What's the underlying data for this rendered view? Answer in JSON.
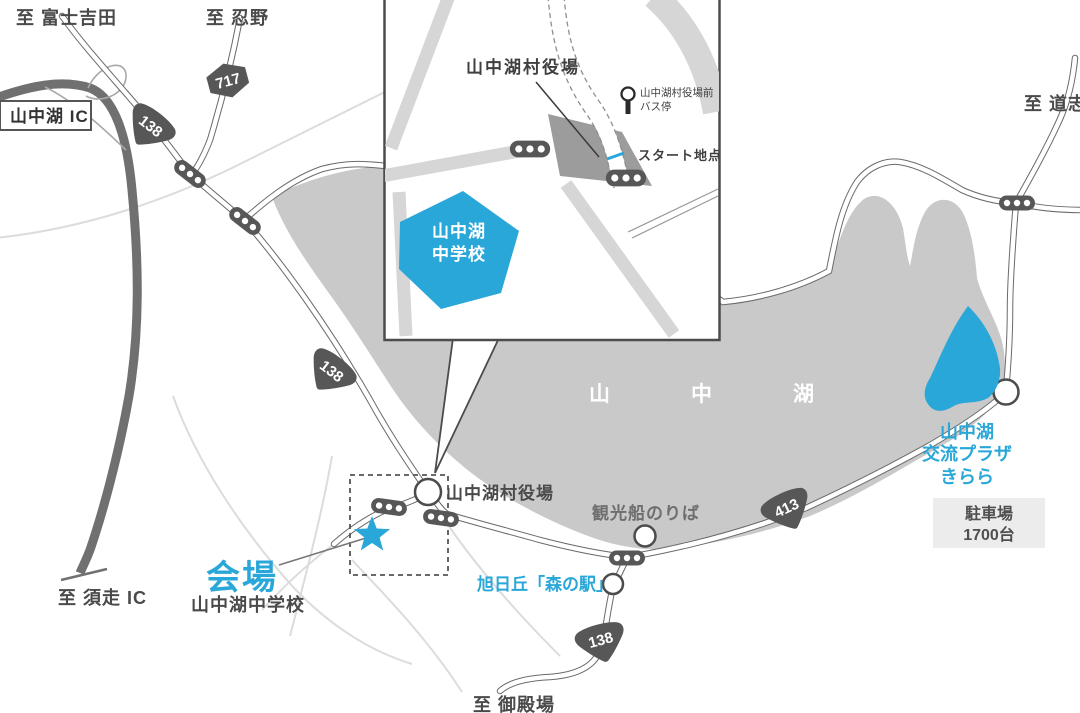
{
  "colors": {
    "accent_blue": "#29a7d8",
    "lake_gray": "#c9c9c9",
    "road_casing_gray": "#6a6a6a",
    "badge_gray": "#575757",
    "building_gray": "#9c9c9c",
    "inset_band_gray": "#d6d6d6"
  },
  "destinations": {
    "fujiyoshida": "至 富士吉田",
    "oshino": "至 忍野",
    "doshi": "至 道志",
    "subashiri_ic": "至 須走 IC",
    "gotemba": "至 御殿場"
  },
  "routes": {
    "r717": "717",
    "r138": "138",
    "r413": "413"
  },
  "interchange_label": "山中湖 IC",
  "lake_name": "山　中　湖",
  "inset": {
    "village_office": "山中湖村役場",
    "bus_stop_line1": "山中湖村役場前",
    "bus_stop_line2": "バス停",
    "start_point": "スタート地点",
    "school_line1": "山中湖",
    "school_line2": "中学校"
  },
  "landmarks": {
    "village_office": "山中湖村役場",
    "boat_dock": "観光船のりば",
    "mori_no_eki": "旭日丘「森の駅」",
    "kirara_line1": "山中湖",
    "kirara_line2": "交流プラザ",
    "kirara_line3": "きらら",
    "parking_line1": "駐車場",
    "parking_line2": "1700台"
  },
  "venue": {
    "label": "会場",
    "name": "山中湖中学校"
  }
}
